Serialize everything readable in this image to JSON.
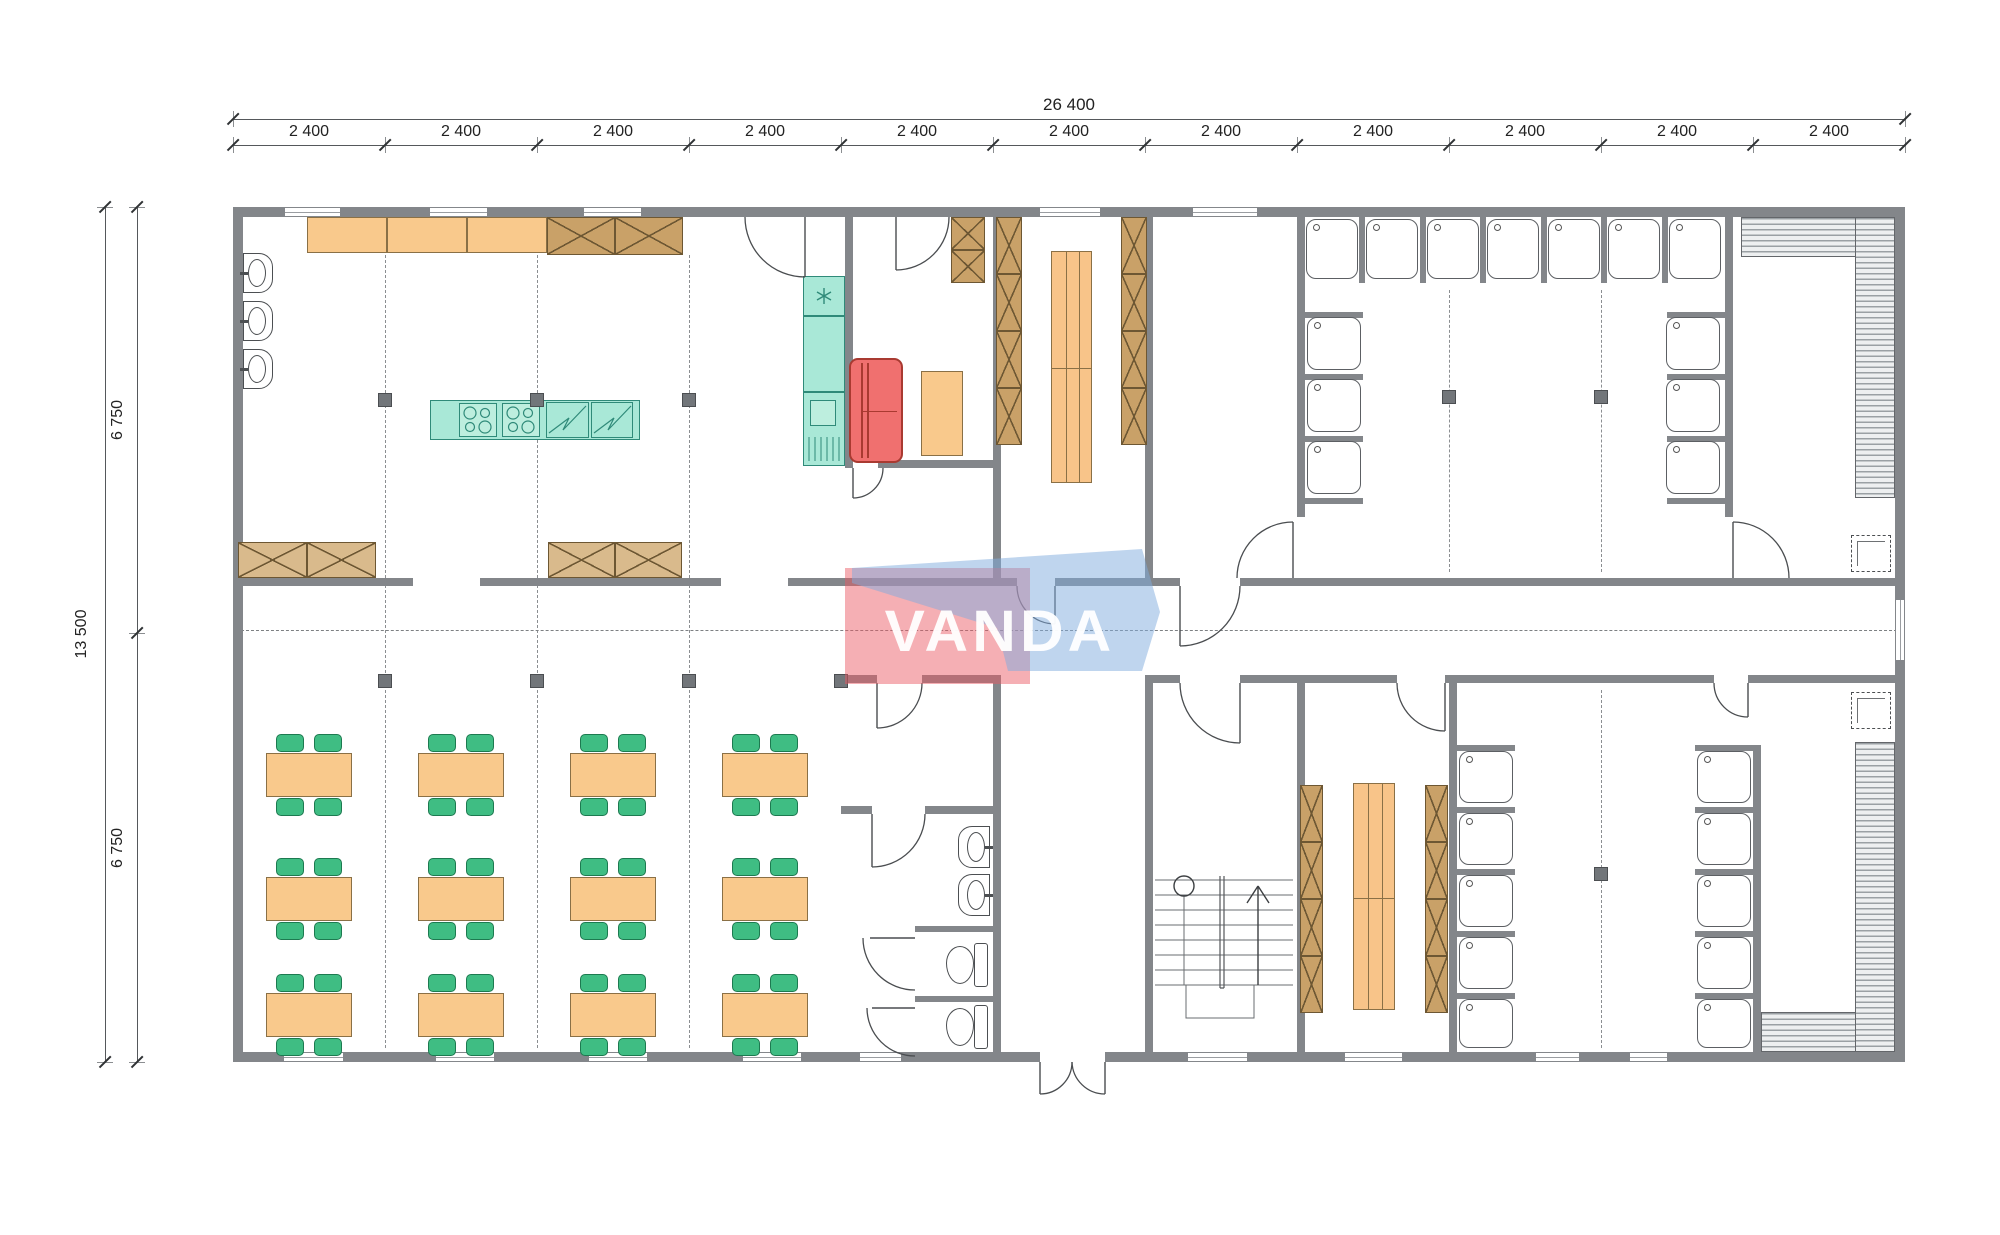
{
  "drawing": {
    "kind": "modular building floor plan"
  },
  "watermark": {
    "text": "VANDA",
    "red": "rgba(235,88,98,0.48)",
    "blue": "rgba(128,172,221,0.50)"
  },
  "dimensions": {
    "top_total": "26 400",
    "top_bays": [
      "2 400",
      "2 400",
      "2 400",
      "2 400",
      "2 400",
      "2 400",
      "2 400",
      "2 400",
      "2 400",
      "2 400",
      "2 400"
    ],
    "left_total": "13 500",
    "left_halves": [
      "6 750",
      "6 750"
    ]
  },
  "colors": {
    "wall": "#83868a",
    "detail_line": "#4c4f52",
    "counter_orange": "#f9c98c",
    "cabinet_tan": "#c9a168",
    "cabinet_tan_light": "#d9ba8c",
    "appliance_teal": "#a9e8d7",
    "appliance_teal_light": "#bdeede",
    "teal_line": "#2f8a79",
    "sofa_red": "#f0706f",
    "chair_green": "#3fbd83",
    "bench_orange": "#f8c489"
  }
}
